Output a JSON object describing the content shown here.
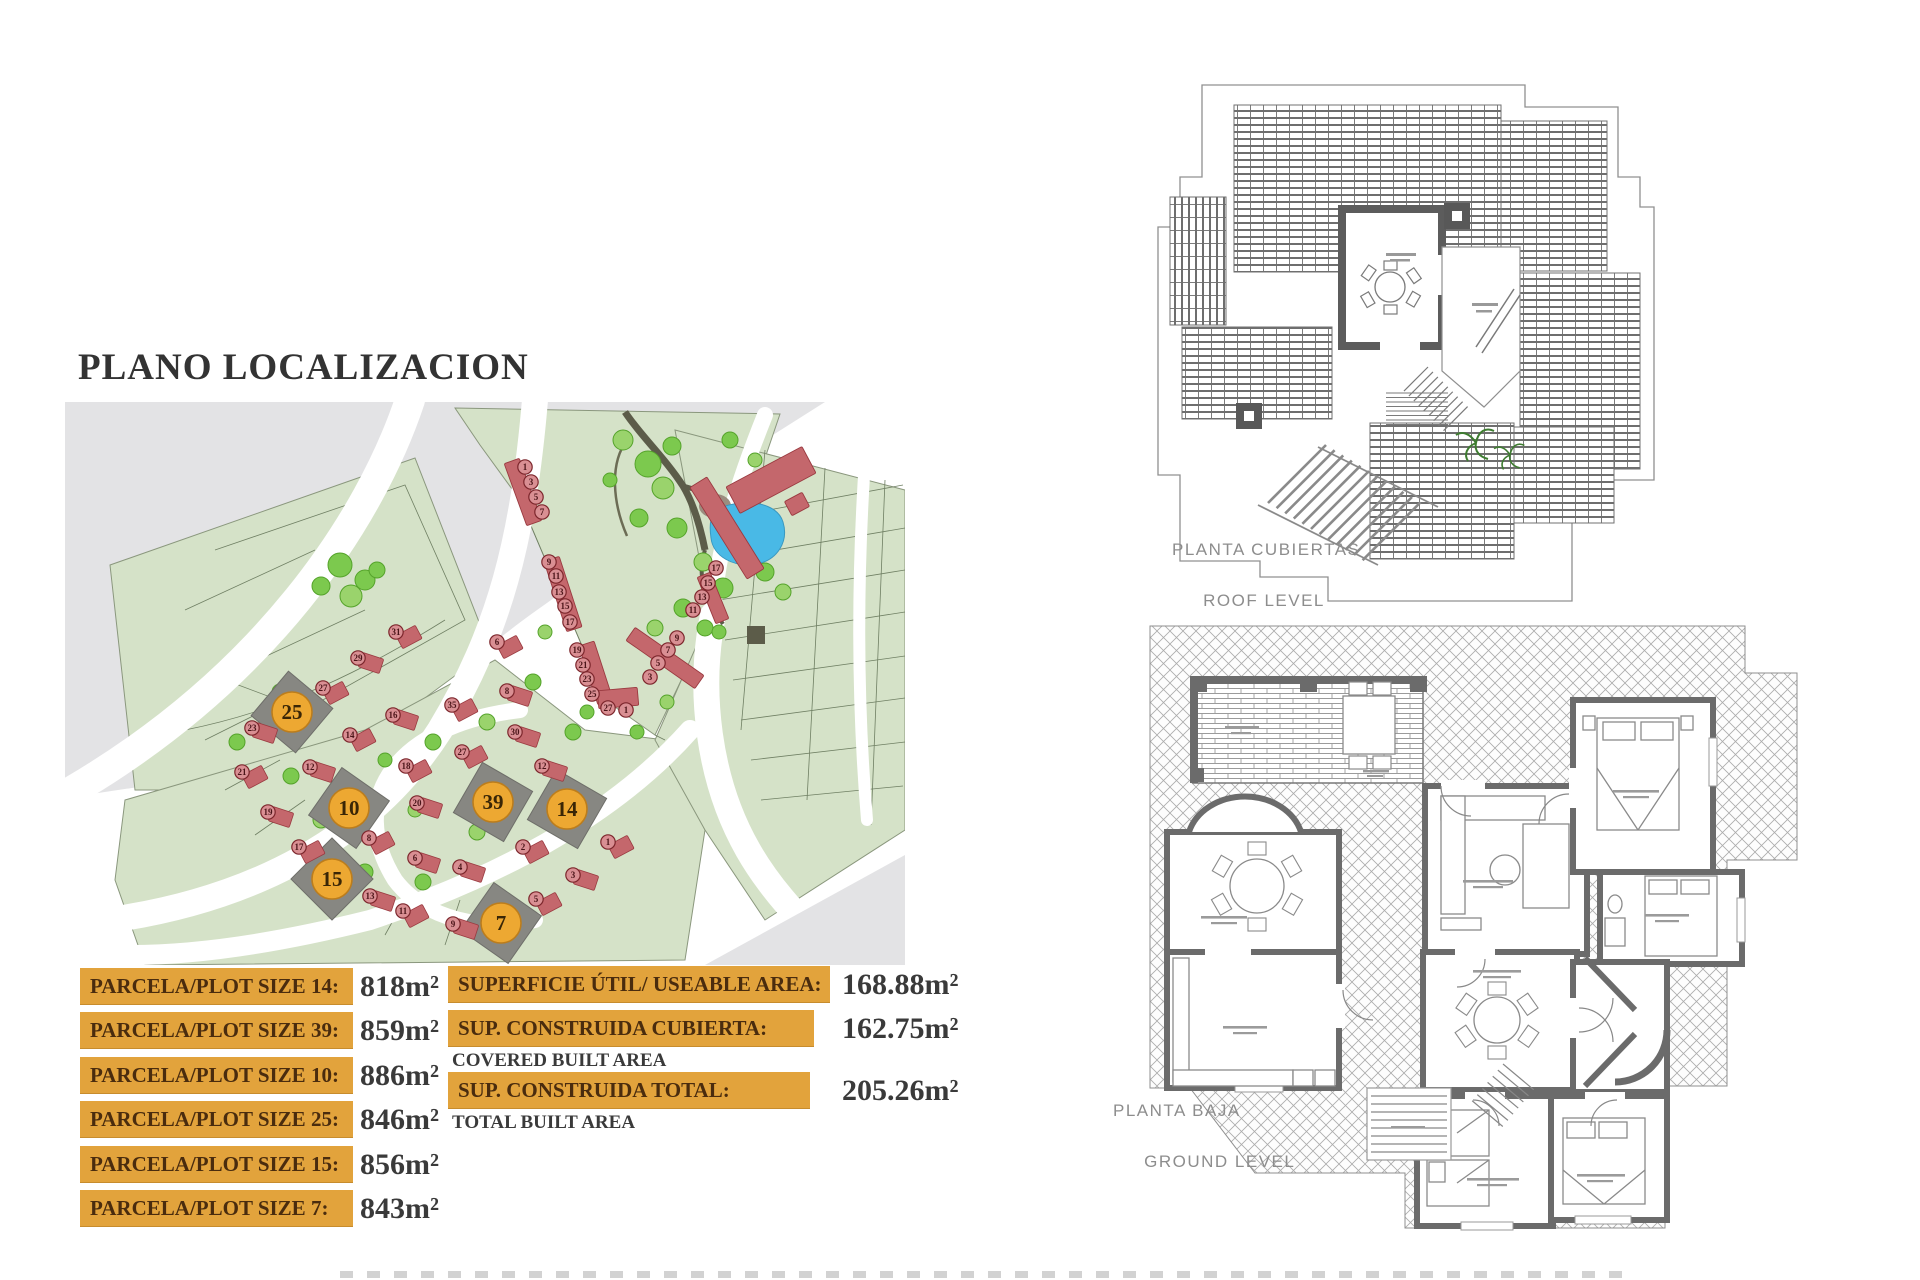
{
  "title": "PLANO LOCALIZACION",
  "plot_table": {
    "rows": [
      {
        "label": "PARCELA/PLOT SIZE 14:",
        "value": "818m²"
      },
      {
        "label": "PARCELA/PLOT SIZE 39:",
        "value": "859m²"
      },
      {
        "label": "PARCELA/PLOT SIZE 10:",
        "value": "886m²"
      },
      {
        "label": "PARCELA/PLOT SIZE 25:",
        "value": "846m²"
      },
      {
        "label": "PARCELA/PLOT SIZE 15:",
        "value": "856m²"
      },
      {
        "label": "PARCELA/PLOT SIZE 7:",
        "value": "843m²"
      }
    ]
  },
  "area_table": {
    "rows": [
      {
        "label": "SUPERFICIE ÚTIL/ USEABLE AREA:",
        "value": "168.88m²",
        "sublabel": ""
      },
      {
        "label": "SUP. CONSTRUIDA CUBIERTA:",
        "value": "162.75m²",
        "sublabel": "COVERED BUILT AREA"
      },
      {
        "label": "SUP. CONSTRUIDA TOTAL:",
        "value": "205.26m²",
        "sublabel": "TOTAL BUILT AREA"
      }
    ]
  },
  "roof_plan": {
    "label_line1": "PLANTA CUBIERTAS",
    "label_line2": "ROOF LEVEL"
  },
  "ground_plan": {
    "label_line1": "PLANTA BAJA",
    "label_line2": "GROUND LEVEL"
  },
  "map": {
    "colors": {
      "green": "#d5e2c8",
      "parcel_line": "#6f7f63",
      "gray": "#e3e3e5",
      "house": "#c4676c",
      "house_stroke": "#9a3a40",
      "circle_fill": "#d98f93",
      "circle_stroke": "#7c262c",
      "circle_text": "#4b1519",
      "plot_dark": "#878782",
      "plot_circle": "#eda832",
      "plot_circle_stroke": "#bc7d1c",
      "plot_text": "#3a2606",
      "pond": "#49b9e6",
      "tree": "#7cc94e",
      "tree2": "#9ad36c",
      "path_dark": "#5c5c49"
    },
    "highlighted_plots": [
      {
        "n": "25",
        "x": 227,
        "y": 332,
        "rot": 40
      },
      {
        "n": "10",
        "x": 284,
        "y": 428,
        "rot": 35
      },
      {
        "n": "39",
        "x": 428,
        "y": 422,
        "rot": 30
      },
      {
        "n": "14",
        "x": 502,
        "y": 429,
        "rot": 30
      },
      {
        "n": "15",
        "x": 267,
        "y": 499,
        "rot": 45
      },
      {
        "n": "7",
        "x": 436,
        "y": 543,
        "rot": 35
      }
    ],
    "house_circles": [
      [
        460,
        87,
        "1",
        0
      ],
      [
        466,
        102,
        "3",
        0
      ],
      [
        471,
        117,
        "5",
        0
      ],
      [
        477,
        132,
        "7",
        0
      ],
      [
        484,
        182,
        "9",
        0
      ],
      [
        491,
        196,
        "11",
        0
      ],
      [
        494,
        212,
        "13",
        0
      ],
      [
        500,
        226,
        "15",
        0
      ],
      [
        505,
        242,
        "17",
        0
      ],
      [
        512,
        270,
        "19",
        0
      ],
      [
        518,
        285,
        "21",
        0
      ],
      [
        522,
        299,
        "23",
        0
      ],
      [
        527,
        314,
        "25",
        0
      ],
      [
        543,
        328,
        "27",
        0
      ],
      [
        561,
        330,
        "1",
        0
      ],
      [
        651,
        188,
        "17",
        0
      ],
      [
        643,
        203,
        "15",
        0
      ],
      [
        637,
        217,
        "13",
        0
      ],
      [
        628,
        230,
        "11",
        0
      ],
      [
        612,
        258,
        "9",
        0
      ],
      [
        603,
        270,
        "7",
        0
      ],
      [
        593,
        283,
        "5",
        0
      ],
      [
        585,
        297,
        "3",
        0
      ],
      [
        331,
        252,
        "31",
        1
      ],
      [
        293,
        278,
        "29",
        1
      ],
      [
        258,
        308,
        "27",
        1
      ],
      [
        187,
        348,
        "23",
        1
      ],
      [
        177,
        392,
        "21",
        1
      ],
      [
        203,
        432,
        "19",
        1
      ],
      [
        234,
        467,
        "17",
        1
      ],
      [
        305,
        516,
        "13",
        1
      ],
      [
        338,
        531,
        "11",
        1
      ],
      [
        245,
        387,
        "12",
        1
      ],
      [
        285,
        355,
        "14",
        1
      ],
      [
        328,
        335,
        "16",
        1
      ],
      [
        341,
        386,
        "18",
        1
      ],
      [
        352,
        423,
        "20",
        1
      ],
      [
        304,
        458,
        "8",
        1
      ],
      [
        350,
        478,
        "6",
        1
      ],
      [
        432,
        262,
        "6",
        1
      ],
      [
        442,
        311,
        "8",
        1
      ],
      [
        387,
        325,
        "35",
        1
      ],
      [
        450,
        352,
        "30",
        1
      ],
      [
        397,
        372,
        "27",
        1
      ],
      [
        477,
        386,
        "12",
        1
      ],
      [
        458,
        467,
        "2",
        1
      ],
      [
        395,
        487,
        "4",
        1
      ],
      [
        543,
        462,
        "1",
        1
      ],
      [
        508,
        495,
        "3",
        1
      ],
      [
        471,
        519,
        "5",
        1
      ],
      [
        388,
        544,
        "9",
        1
      ]
    ],
    "house_rows": [
      [
        458,
        112,
        16,
        66,
        -20
      ],
      [
        498,
        214,
        16,
        74,
        -18
      ],
      [
        531,
        293,
        16,
        62,
        -18
      ],
      [
        662,
        148,
        20,
        108,
        -32
      ],
      [
        648,
        218,
        14,
        50,
        -22
      ],
      [
        600,
        278,
        16,
        84,
        -55
      ],
      [
        553,
        318,
        40,
        18,
        -5
      ],
      [
        706,
        100,
        86,
        30,
        -28
      ],
      [
        732,
        124,
        20,
        16,
        -28
      ]
    ],
    "trees": [
      [
        558,
        60,
        10
      ],
      [
        583,
        84,
        13
      ],
      [
        607,
        66,
        9
      ],
      [
        598,
        108,
        11
      ],
      [
        574,
        138,
        9
      ],
      [
        612,
        148,
        10
      ],
      [
        638,
        182,
        9
      ],
      [
        658,
        208,
        10
      ],
      [
        618,
        228,
        9
      ],
      [
        590,
        248,
        8
      ],
      [
        640,
        248,
        8
      ],
      [
        700,
        192,
        9
      ],
      [
        718,
        212,
        8
      ],
      [
        545,
        100,
        7
      ],
      [
        665,
        60,
        8
      ],
      [
        690,
        80,
        7
      ],
      [
        275,
        185,
        12
      ],
      [
        300,
        200,
        10
      ],
      [
        286,
        216,
        11
      ],
      [
        256,
        206,
        9
      ],
      [
        312,
        190,
        8
      ],
      [
        215,
        312,
        8
      ],
      [
        172,
        362,
        8
      ],
      [
        226,
        396,
        8
      ],
      [
        256,
        440,
        8
      ],
      [
        300,
        492,
        8
      ],
      [
        358,
        502,
        8
      ],
      [
        412,
        452,
        8
      ],
      [
        442,
        422,
        8
      ],
      [
        368,
        362,
        8
      ],
      [
        422,
        342,
        8
      ],
      [
        468,
        302,
        8
      ],
      [
        508,
        352,
        8
      ],
      [
        480,
        252,
        7
      ],
      [
        522,
        332,
        7
      ],
      [
        572,
        352,
        7
      ],
      [
        602,
        322,
        7
      ],
      [
        654,
        252,
        7
      ],
      [
        620,
        292,
        7
      ],
      [
        350,
        430,
        7
      ],
      [
        320,
        380,
        7
      ]
    ]
  }
}
